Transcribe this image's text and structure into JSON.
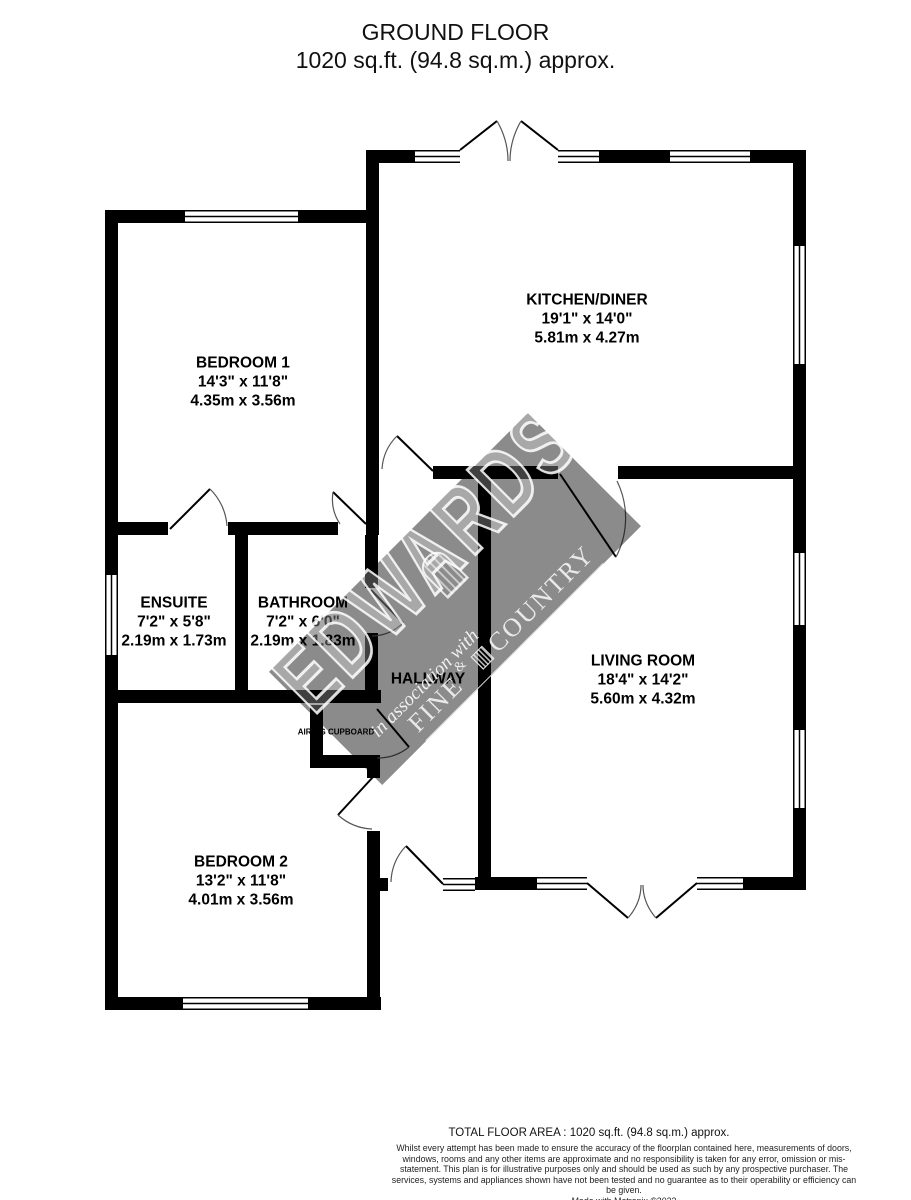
{
  "title": {
    "line1": "GROUND FLOOR",
    "line2": "1020 sq.ft. (94.8 sq.m.) approx."
  },
  "rooms": [
    {
      "id": "bedroom1",
      "name": "BEDROOM 1",
      "imperial": "14'3\"  x 11'8\"",
      "metric": "4.35m  x 3.56m"
    },
    {
      "id": "kitchen",
      "name": "KITCHEN/DINER",
      "imperial": "19'1\"  x 14'0\"",
      "metric": "5.81m  x 4.27m"
    },
    {
      "id": "ensuite",
      "name": "ENSUITE",
      "imperial": "7'2\"  x 5'8\"",
      "metric": "2.19m  x 1.73m"
    },
    {
      "id": "bathroom",
      "name": "BATHROOM",
      "imperial": "7'2\"  x 6'0\"",
      "metric": "2.19m  x 1.83m"
    },
    {
      "id": "hallway",
      "name": "HALLWAY"
    },
    {
      "id": "living",
      "name": "LIVING ROOM",
      "imperial": "18'4\"  x 14'2\"",
      "metric": "5.60m  x 4.32m"
    },
    {
      "id": "bedroom2",
      "name": "BEDROOM 2",
      "imperial": "13'2\"  x 11'8\"",
      "metric": "4.01m  x 3.56m"
    },
    {
      "id": "airing",
      "name": "AIRING CUPBOARD"
    }
  ],
  "watermark": {
    "brand": "EDWARDS",
    "tagline": "in association with",
    "partner_first": "FINE",
    "partner_amp": "&",
    "partner_second": "COUNTRY",
    "band_color": "#8b8b8b"
  },
  "footer": {
    "total": "TOTAL FLOOR AREA : 1020 sq.ft. (94.8 sq.m.) approx.",
    "disclaimer": "Whilst every attempt has been made to ensure the accuracy of the floorplan contained here, measurements of doors, windows, rooms and any other items are approximate and no responsibility is taken for any error, omission or mis-statement. This plan is for illustrative purposes only and should be used as such by any prospective purchaser. The services, systems and appliances shown have not been tested and no guarantee as to their operability or efficiency can be given.",
    "credit": "Made with Metropix ©2022"
  }
}
